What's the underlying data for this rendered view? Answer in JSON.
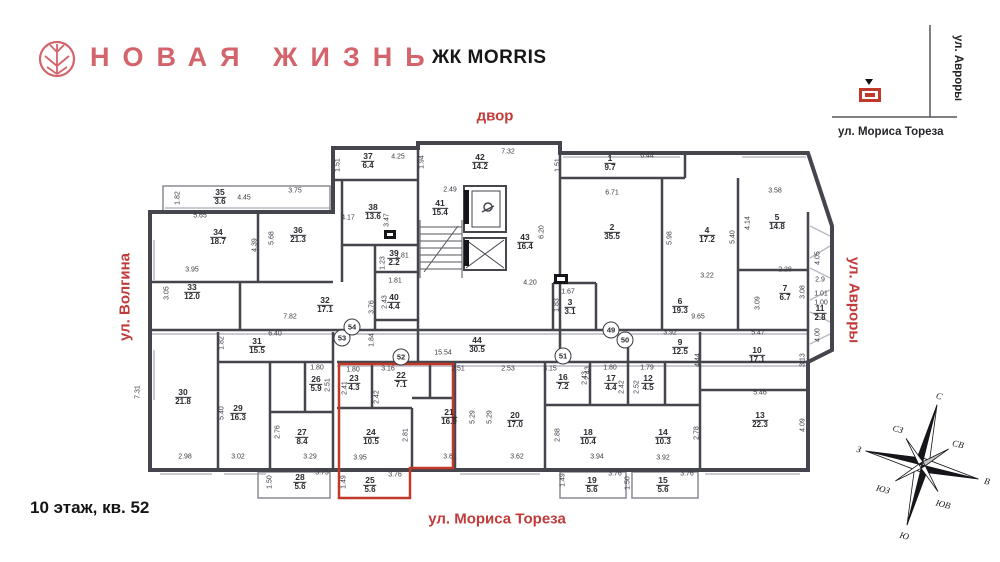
{
  "header": {
    "brand": "НОВАЯ ЖИЗНЬ",
    "complex": "ЖК MORRIS"
  },
  "footer": {
    "floor_info": "10 этаж, кв. 52"
  },
  "streets": {
    "top": "двор",
    "left": "ул. Волгина",
    "right": "ул. Авроры",
    "bottom": "ул. Мориса Тореза"
  },
  "minimap": {
    "vertical_street": "ул. Авроры",
    "horizontal_street": "ул. Мориса Тореза"
  },
  "compass": {
    "n": "С",
    "ne": "СВ",
    "e": "В",
    "se": "ЮВ",
    "s": "Ю",
    "sw": "ЮЗ",
    "w": "З",
    "nw": "СЗ"
  },
  "colors": {
    "brand": "#D4646C",
    "street_label": "#C13B3B",
    "highlight_outline": "#C0392B",
    "wall": "#45454D"
  },
  "highlight_apartment": {
    "floor": "10",
    "number": "52",
    "room_numbers": [
      "21",
      "22",
      "23",
      "24",
      "25"
    ]
  },
  "rooms": [
    {
      "n": "1",
      "a": "9.7",
      "x": 610,
      "y": 163
    },
    {
      "n": "2",
      "a": "35.5",
      "x": 612,
      "y": 232
    },
    {
      "n": "3",
      "a": "3.1",
      "x": 570,
      "y": 307
    },
    {
      "n": "4",
      "a": "17.2",
      "x": 707,
      "y": 235
    },
    {
      "n": "5",
      "a": "14.8",
      "x": 777,
      "y": 222
    },
    {
      "n": "6",
      "a": "19.3",
      "x": 680,
      "y": 306
    },
    {
      "n": "7",
      "a": "6.7",
      "x": 785,
      "y": 293
    },
    {
      "n": "9",
      "a": "12.5",
      "x": 680,
      "y": 347
    },
    {
      "n": "10",
      "a": "17.1",
      "x": 757,
      "y": 355
    },
    {
      "n": "11",
      "a": "2.8",
      "x": 820,
      "y": 313
    },
    {
      "n": "12",
      "a": "4.5",
      "x": 648,
      "y": 383
    },
    {
      "n": "13",
      "a": "22.3",
      "x": 760,
      "y": 420
    },
    {
      "n": "14",
      "a": "10.3",
      "x": 663,
      "y": 437
    },
    {
      "n": "15",
      "a": "5.6",
      "x": 663,
      "y": 485
    },
    {
      "n": "16",
      "a": "7.2",
      "x": 563,
      "y": 382
    },
    {
      "n": "17",
      "a": "4.4",
      "x": 611,
      "y": 383
    },
    {
      "n": "18",
      "a": "10.4",
      "x": 588,
      "y": 437
    },
    {
      "n": "19",
      "a": "5.6",
      "x": 592,
      "y": 485
    },
    {
      "n": "20",
      "a": "17.0",
      "x": 515,
      "y": 420
    },
    {
      "n": "21",
      "a": "16.9",
      "x": 449,
      "y": 417,
      "hl": true
    },
    {
      "n": "22",
      "a": "7.1",
      "x": 401,
      "y": 380,
      "hl": true
    },
    {
      "n": "23",
      "a": "4.3",
      "x": 354,
      "y": 383,
      "hl": true
    },
    {
      "n": "24",
      "a": "10.5",
      "x": 371,
      "y": 437,
      "hl": true
    },
    {
      "n": "25",
      "a": "5.6",
      "x": 370,
      "y": 485,
      "hl": true
    },
    {
      "n": "26",
      "a": "5.9",
      "x": 316,
      "y": 384
    },
    {
      "n": "27",
      "a": "8.4",
      "x": 302,
      "y": 437
    },
    {
      "n": "28",
      "a": "5.6",
      "x": 300,
      "y": 482
    },
    {
      "n": "29",
      "a": "16.3",
      "x": 238,
      "y": 413
    },
    {
      "n": "30",
      "a": "21.8",
      "x": 183,
      "y": 397
    },
    {
      "n": "31",
      "a": "15.5",
      "x": 257,
      "y": 346
    },
    {
      "n": "32",
      "a": "17.1",
      "x": 325,
      "y": 305
    },
    {
      "n": "33",
      "a": "12.0",
      "x": 192,
      "y": 292
    },
    {
      "n": "34",
      "a": "18.7",
      "x": 218,
      "y": 237
    },
    {
      "n": "35",
      "a": "3.6",
      "x": 220,
      "y": 197
    },
    {
      "n": "36",
      "a": "21.3",
      "x": 298,
      "y": 235
    },
    {
      "n": "37",
      "a": "6.4",
      "x": 368,
      "y": 161
    },
    {
      "n": "38",
      "a": "13.6",
      "x": 373,
      "y": 212
    },
    {
      "n": "39",
      "a": "2.2",
      "x": 394,
      "y": 258
    },
    {
      "n": "40",
      "a": "4.4",
      "x": 394,
      "y": 302
    },
    {
      "n": "41",
      "a": "15.4",
      "x": 440,
      "y": 208
    },
    {
      "n": "42",
      "a": "14.2",
      "x": 480,
      "y": 162
    },
    {
      "n": "43",
      "a": "16.4",
      "x": 525,
      "y": 242
    },
    {
      "n": "44",
      "a": "30.5",
      "x": 477,
      "y": 345
    }
  ],
  "dims": [
    {
      "t": "5.65",
      "x": 200,
      "y": 216
    },
    {
      "t": "4.45",
      "x": 244,
      "y": 198
    },
    {
      "t": "3.75",
      "x": 295,
      "y": 191
    },
    {
      "t": "4.25",
      "x": 398,
      "y": 157
    },
    {
      "t": "4.17",
      "x": 348,
      "y": 218
    },
    {
      "t": "3.95",
      "x": 192,
      "y": 270
    },
    {
      "t": "1.81",
      "x": 402,
      "y": 256
    },
    {
      "t": "1.81",
      "x": 395,
      "y": 281
    },
    {
      "t": "7.82",
      "x": 290,
      "y": 317
    },
    {
      "t": "6.40",
      "x": 275,
      "y": 334
    },
    {
      "t": "2.49",
      "x": 450,
      "y": 190
    },
    {
      "t": "7.32",
      "x": 508,
      "y": 152
    },
    {
      "t": "6.44",
      "x": 647,
      "y": 156
    },
    {
      "t": "6.71",
      "x": 612,
      "y": 193
    },
    {
      "t": "4.20",
      "x": 530,
      "y": 283
    },
    {
      "t": "1.67",
      "x": 568,
      "y": 292
    },
    {
      "t": "3.58",
      "x": 775,
      "y": 191
    },
    {
      "t": "3.22",
      "x": 707,
      "y": 276
    },
    {
      "t": "2.28",
      "x": 785,
      "y": 270
    },
    {
      "t": "9.65",
      "x": 698,
      "y": 317
    },
    {
      "t": "3.92",
      "x": 670,
      "y": 333
    },
    {
      "t": "5.47",
      "x": 758,
      "y": 333
    },
    {
      "t": "5.46",
      "x": 760,
      "y": 393
    },
    {
      "t": "2.9",
      "x": 820,
      "y": 280
    },
    {
      "t": "1.01",
      "x": 821,
      "y": 294
    },
    {
      "t": "1.00",
      "x": 821,
      "y": 303
    },
    {
      "t": "15.54",
      "x": 443,
      "y": 353
    },
    {
      "t": "1.80",
      "x": 353,
      "y": 370
    },
    {
      "t": "3.16",
      "x": 388,
      "y": 369
    },
    {
      "t": "2.51",
      "x": 458,
      "y": 369
    },
    {
      "t": "2.53",
      "x": 508,
      "y": 369
    },
    {
      "t": "3.15",
      "x": 550,
      "y": 369
    },
    {
      "t": "1.80",
      "x": 610,
      "y": 368
    },
    {
      "t": "1.79",
      "x": 647,
      "y": 368
    },
    {
      "t": "1.80",
      "x": 317,
      "y": 368
    },
    {
      "t": "3.61",
      "x": 450,
      "y": 457
    },
    {
      "t": "3.62",
      "x": 517,
      "y": 457
    },
    {
      "t": "3.95",
      "x": 360,
      "y": 458
    },
    {
      "t": "3.76",
      "x": 395,
      "y": 475
    },
    {
      "t": "3.75",
      "x": 322,
      "y": 473
    },
    {
      "t": "3.29",
      "x": 310,
      "y": 457
    },
    {
      "t": "3.02",
      "x": 238,
      "y": 457
    },
    {
      "t": "2.98",
      "x": 185,
      "y": 457
    },
    {
      "t": "3.94",
      "x": 597,
      "y": 457
    },
    {
      "t": "3.92",
      "x": 663,
      "y": 458
    },
    {
      "t": "3.76",
      "x": 615,
      "y": 474
    },
    {
      "t": "3.76",
      "x": 687,
      "y": 474
    },
    {
      "t": "1.82",
      "x": 178,
      "y": 198,
      "v": 1
    },
    {
      "t": "1.51",
      "x": 338,
      "y": 165,
      "v": 1
    },
    {
      "t": "3.47",
      "x": 387,
      "y": 220,
      "v": 1
    },
    {
      "t": "4.39",
      "x": 255,
      "y": 245,
      "v": 1
    },
    {
      "t": "5.68",
      "x": 272,
      "y": 238,
      "v": 1
    },
    {
      "t": "3.05",
      "x": 167,
      "y": 293,
      "v": 1
    },
    {
      "t": "1.23",
      "x": 383,
      "y": 263,
      "v": 1
    },
    {
      "t": "2.43",
      "x": 385,
      "y": 302,
      "v": 1
    },
    {
      "t": "3.76",
      "x": 372,
      "y": 307,
      "v": 1
    },
    {
      "t": "1.94",
      "x": 422,
      "y": 162,
      "v": 1
    },
    {
      "t": "1.51",
      "x": 558,
      "y": 165,
      "v": 1
    },
    {
      "t": "6.20",
      "x": 542,
      "y": 232,
      "v": 1
    },
    {
      "t": "5.98",
      "x": 670,
      "y": 238,
      "v": 1
    },
    {
      "t": "1.83",
      "x": 557,
      "y": 305,
      "v": 1
    },
    {
      "t": "5.40",
      "x": 733,
      "y": 237,
      "v": 1
    },
    {
      "t": "4.14",
      "x": 748,
      "y": 223,
      "v": 1
    },
    {
      "t": "3.08",
      "x": 803,
      "y": 292,
      "v": 1
    },
    {
      "t": "3.09",
      "x": 758,
      "y": 303,
      "v": 1
    },
    {
      "t": "4.05",
      "x": 818,
      "y": 258,
      "v": 1
    },
    {
      "t": "4.00",
      "x": 818,
      "y": 335,
      "v": 1
    },
    {
      "t": "3.13",
      "x": 803,
      "y": 360,
      "v": 1
    },
    {
      "t": "4.09",
      "x": 803,
      "y": 425,
      "v": 1
    },
    {
      "t": "4.44",
      "x": 698,
      "y": 360,
      "v": 1
    },
    {
      "t": "2.78",
      "x": 697,
      "y": 433,
      "v": 1
    },
    {
      "t": "2.41",
      "x": 345,
      "y": 388,
      "v": 1
    },
    {
      "t": "2.42",
      "x": 377,
      "y": 397,
      "v": 1
    },
    {
      "t": "5.29",
      "x": 473,
      "y": 417,
      "v": 1
    },
    {
      "t": "5.29",
      "x": 490,
      "y": 417,
      "v": 1
    },
    {
      "t": "2.81",
      "x": 406,
      "y": 435,
      "v": 1
    },
    {
      "t": "1.49",
      "x": 344,
      "y": 482,
      "v": 1
    },
    {
      "t": "2.88",
      "x": 558,
      "y": 435,
      "v": 1
    },
    {
      "t": "2.43",
      "x": 585,
      "y": 378,
      "v": 1
    },
    {
      "t": "2.52",
      "x": 637,
      "y": 387,
      "v": 1
    },
    {
      "t": "2.43",
      "x": 588,
      "y": 373,
      "v": 1
    },
    {
      "t": "2.42",
      "x": 622,
      "y": 387,
      "v": 1
    },
    {
      "t": "1.50",
      "x": 628,
      "y": 483,
      "v": 1
    },
    {
      "t": "1.49",
      "x": 563,
      "y": 480,
      "v": 1
    },
    {
      "t": "7.31",
      "x": 138,
      "y": 392,
      "v": 1
    },
    {
      "t": "5.40",
      "x": 222,
      "y": 413,
      "v": 1
    },
    {
      "t": "1.82",
      "x": 222,
      "y": 343,
      "v": 1
    },
    {
      "t": "2.51",
      "x": 328,
      "y": 385,
      "v": 1
    },
    {
      "t": "2.76",
      "x": 278,
      "y": 432,
      "v": 1
    },
    {
      "t": "1.50",
      "x": 270,
      "y": 482,
      "v": 1
    },
    {
      "t": "1.84",
      "x": 372,
      "y": 340,
      "v": 1
    }
  ],
  "markers": [
    {
      "t": "49",
      "x": 611,
      "y": 330
    },
    {
      "t": "50",
      "x": 625,
      "y": 340
    },
    {
      "t": "51",
      "x": 563,
      "y": 356
    },
    {
      "t": "52",
      "x": 401,
      "y": 357
    },
    {
      "t": "53",
      "x": 342,
      "y": 338
    },
    {
      "t": "54",
      "x": 352,
      "y": 327
    }
  ]
}
